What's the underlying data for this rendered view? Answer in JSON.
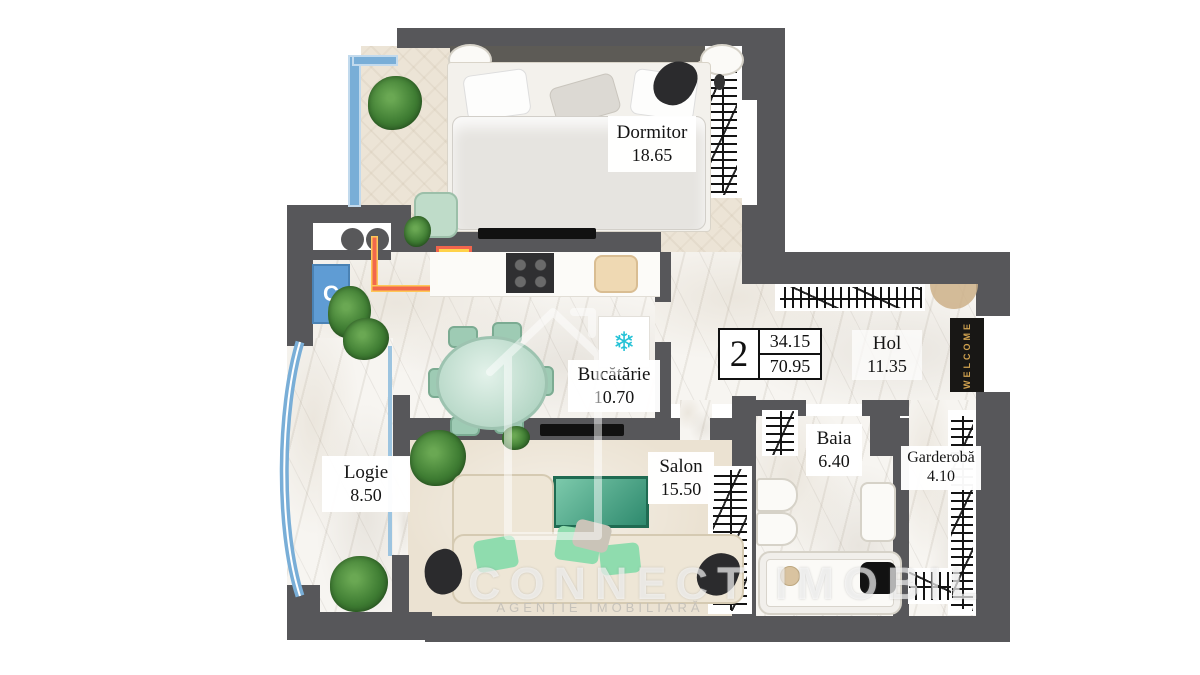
{
  "plan_title": "Apartment floor plan",
  "rooms": [
    {
      "id": "dormitor",
      "name": "Dormitor",
      "area": "18.65"
    },
    {
      "id": "bucatarie",
      "name": "Bucătărie",
      "area": "10.70"
    },
    {
      "id": "hol",
      "name": "Hol",
      "area": "11.35"
    },
    {
      "id": "baia",
      "name": "Baia",
      "area": "6.40"
    },
    {
      "id": "garderoba",
      "name": "Garderobă",
      "area": "4.10"
    },
    {
      "id": "salon",
      "name": "Salon",
      "area": "15.50"
    },
    {
      "id": "logie",
      "name": "Logie",
      "area": "8.50"
    }
  ],
  "area_table": {
    "apartment_number": "2",
    "living_area": "34.15",
    "total_area": "70.95"
  },
  "annotations": {
    "welcome_mat": "WELCOME",
    "gas_riser_label": "C",
    "fridge_snowflake": "❄"
  },
  "watermark": {
    "brand": "CONNECT IMOBIL",
    "subtitle": "AGENȚIE IMOBILIARĂ"
  },
  "colors": {
    "wall": "#57575a",
    "window_blue": "#79aed7",
    "mint_accent": "#9ecbb4",
    "pipe_orange": "#f2684c",
    "boiler_yellow": "#ffd24a",
    "snowflake_teal": "#25c2d6",
    "mat_gold": "#cfa14f"
  }
}
